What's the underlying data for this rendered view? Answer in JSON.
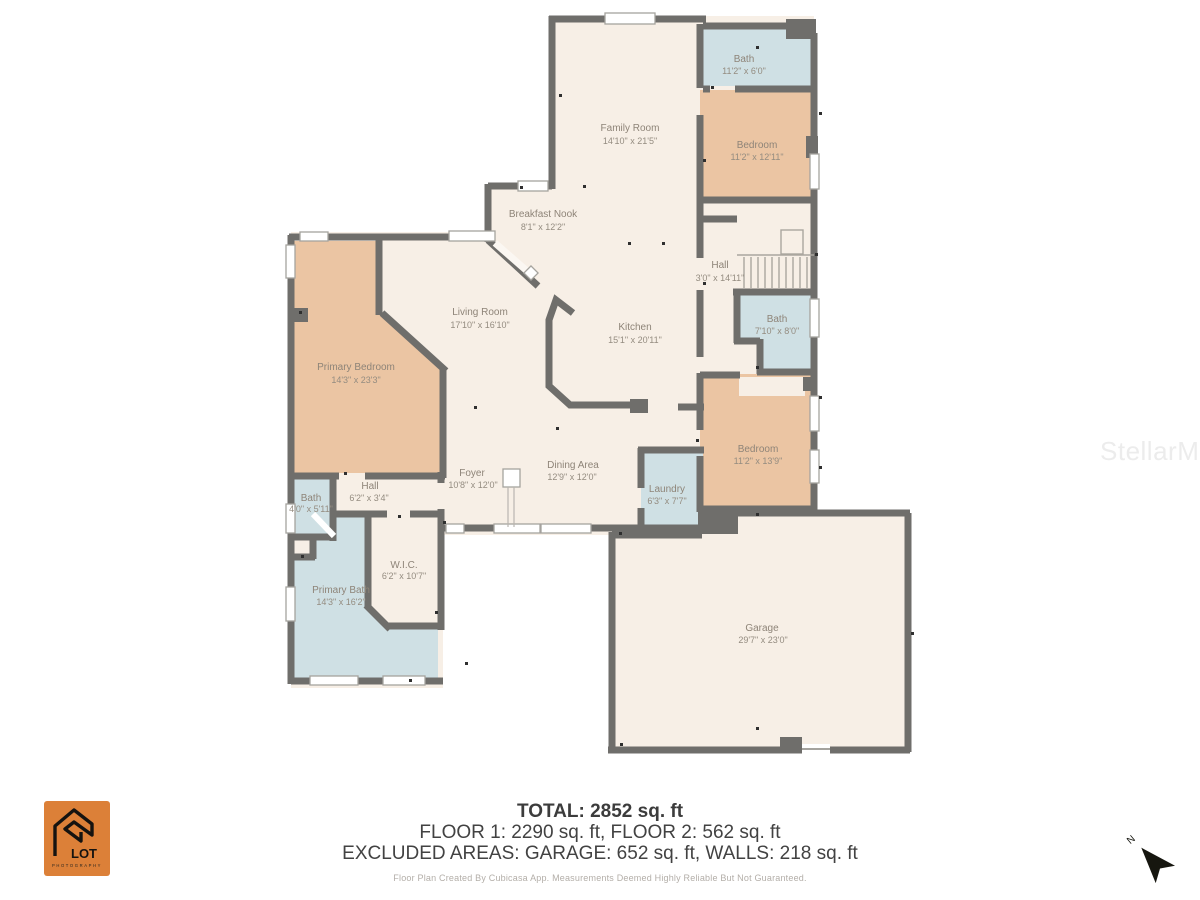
{
  "rooms": {
    "family_room": {
      "name": "Family Room",
      "dims": "14'10\" x 21'5\""
    },
    "bath_upper": {
      "name": "Bath",
      "dims": "11'2\" x 6'0\""
    },
    "bedroom_upper": {
      "name": "Bedroom",
      "dims": "11'2\" x 12'11\""
    },
    "breakfast_nook": {
      "name": "Breakfast Nook",
      "dims": "8'1\" x 12'2\""
    },
    "hall_upper": {
      "name": "Hall",
      "dims": "3'0\" x 14'11\""
    },
    "living_room": {
      "name": "Living Room",
      "dims": "17'10\" x 16'10\""
    },
    "kitchen": {
      "name": "Kitchen",
      "dims": "15'1\" x 20'11\""
    },
    "bath_mid": {
      "name": "Bath",
      "dims": "7'10\" x 8'0\""
    },
    "primary_bedroom": {
      "name": "Primary Bedroom",
      "dims": "14'3\" x 23'3\""
    },
    "bedroom_right": {
      "name": "Bedroom",
      "dims": "11'2\" x 13'9\""
    },
    "foyer": {
      "name": "Foyer",
      "dims": "10'8\" x 12'0\""
    },
    "dining_area": {
      "name": "Dining Area",
      "dims": "12'9\" x 12'0\""
    },
    "laundry": {
      "name": "Laundry",
      "dims": "6'3\" x 7'7\""
    },
    "bath_left": {
      "name": "Bath",
      "dims": "4'0\" x 5'11\""
    },
    "hall_left": {
      "name": "Hall",
      "dims": "6'2\" x 3'4\""
    },
    "wic": {
      "name": "W.I.C.",
      "dims": "6'2\" x 10'7\""
    },
    "primary_bath": {
      "name": "Primary Bath",
      "dims": "14'3\" x 16'2\""
    },
    "garage": {
      "name": "Garage",
      "dims": "29'7\" x 23'0\""
    }
  },
  "summary": {
    "total": "TOTAL: 2852 sq. ft",
    "floors": "FLOOR 1: 2290 sq. ft, FLOOR 2: 562 sq. ft",
    "excluded": "EXCLUDED AREAS: GARAGE: 652 sq. ft, WALLS: 218 sq. ft",
    "disclaimer": "Floor Plan Created By Cubicasa App. Measurements Deemed Highly Reliable But Not Guaranteed."
  },
  "watermark": "StellarMLS",
  "compass": {
    "label": "N"
  },
  "logo": {
    "name": "LOT",
    "subtitle": "PHOTOGRAPHY"
  },
  "colors": {
    "floor": "#f7efe6",
    "bedroom_fill": "#ebc5a3",
    "wet_room_fill": "#cfe0e4",
    "wall": "#6f6e6b",
    "label_text": "#8e8478",
    "logo_bg": "#dc8038"
  }
}
